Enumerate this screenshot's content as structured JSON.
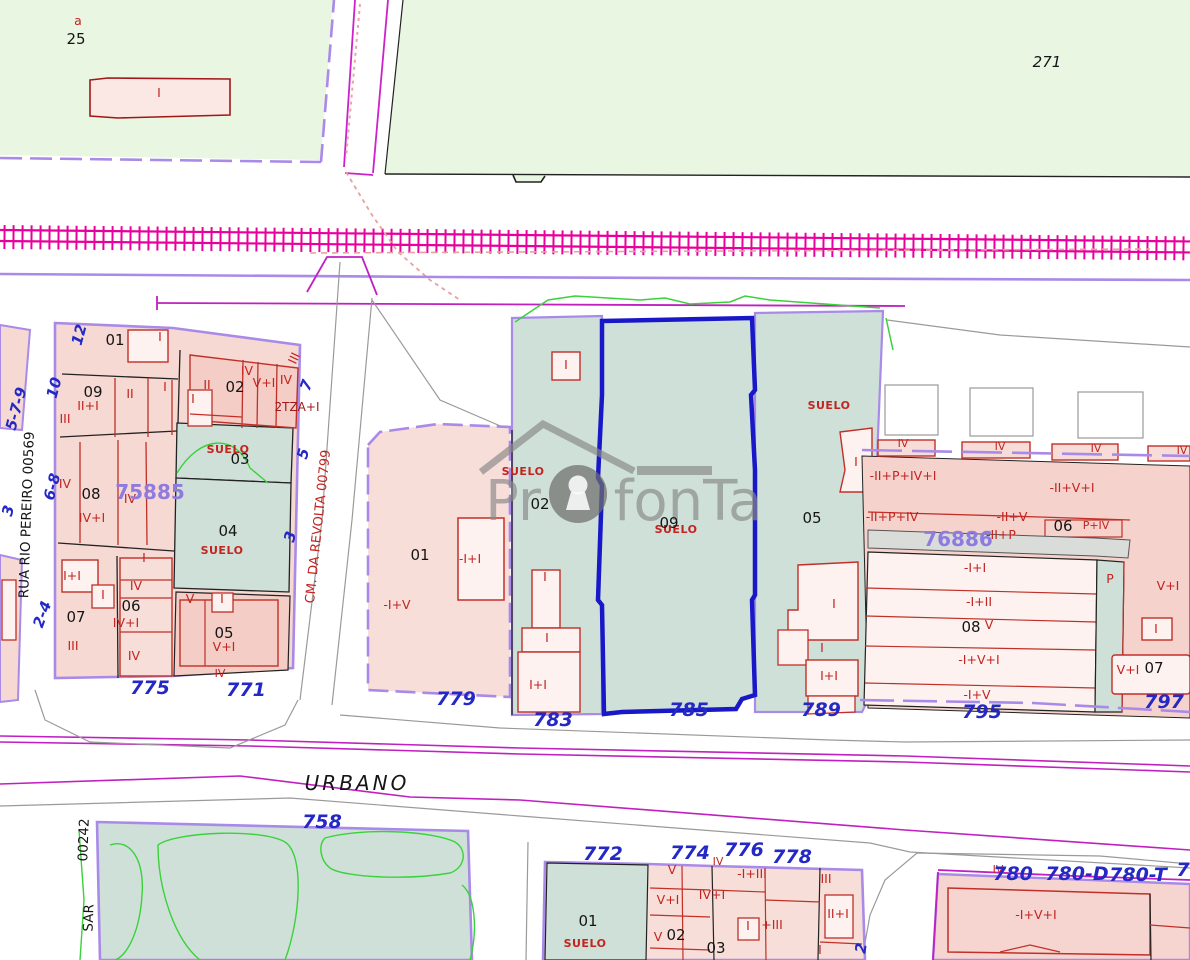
{
  "map": {
    "watermark": {
      "pr": "Pr",
      "rest": "fonTa"
    },
    "colors": {
      "green_bg": "#e9f6e2",
      "teal_suelo": "#cfe0d8",
      "pink_parcel": "#f6d9d3",
      "pink_light": "#fdf2ef",
      "pink_mid": "#f3cdc6",
      "boundary_purple": "#a98ae8",
      "selected_blue": "#1818c8",
      "railway_magenta": "#e8009c",
      "road_magenta": "#cc22cc",
      "building_red": "#c03028",
      "label_red": "#c22420",
      "street_number_blue": "#2428c4",
      "block_ref_purple": "#8f7ae0",
      "contour_green": "#3ad23a",
      "sidewalk_gray": "#9a9a9a"
    },
    "labels": [
      {
        "t": "a",
        "x": 78,
        "y": 25,
        "c": "red"
      },
      {
        "t": "25",
        "x": 76,
        "y": 44,
        "c": "blk"
      },
      {
        "t": "I",
        "x": 159,
        "y": 97,
        "c": "red"
      },
      {
        "t": "271",
        "x": 1047,
        "y": 67,
        "c": "ital"
      },
      {
        "t": "01",
        "x": 115,
        "y": 345,
        "c": "blk"
      },
      {
        "t": "I",
        "x": 160,
        "y": 341,
        "c": "red"
      },
      {
        "t": "02",
        "x": 235,
        "y": 392,
        "c": "blk"
      },
      {
        "t": "II",
        "x": 207,
        "y": 389,
        "c": "red"
      },
      {
        "t": "IV",
        "x": 247,
        "y": 375,
        "c": "red"
      },
      {
        "t": "V+I",
        "x": 264,
        "y": 387,
        "c": "red"
      },
      {
        "t": "IV",
        "x": 286,
        "y": 384,
        "c": "red"
      },
      {
        "t": "III",
        "x": 298,
        "y": 360,
        "c": "red",
        "rot": -65
      },
      {
        "t": "2TZA+I",
        "x": 297,
        "y": 411,
        "c": "dred"
      },
      {
        "t": "09",
        "x": 93,
        "y": 397,
        "c": "blk"
      },
      {
        "t": "II+I",
        "x": 88,
        "y": 410,
        "c": "red"
      },
      {
        "t": "II",
        "x": 130,
        "y": 398,
        "c": "red"
      },
      {
        "t": "I",
        "x": 165,
        "y": 391,
        "c": "red"
      },
      {
        "t": "I",
        "x": 193,
        "y": 403,
        "c": "red"
      },
      {
        "t": "III",
        "x": 65,
        "y": 423,
        "c": "red"
      },
      {
        "t": "SUELO",
        "x": 228,
        "y": 453,
        "c": "suelo"
      },
      {
        "t": "03",
        "x": 240,
        "y": 464,
        "c": "blk"
      },
      {
        "t": "IV",
        "x": 65,
        "y": 488,
        "c": "red"
      },
      {
        "t": "08",
        "x": 91,
        "y": 499,
        "c": "blk"
      },
      {
        "t": "IV",
        "x": 130,
        "y": 503,
        "c": "red"
      },
      {
        "t": "IV+I",
        "x": 92,
        "y": 522,
        "c": "red"
      },
      {
        "t": "75885",
        "x": 150,
        "y": 499,
        "c": "ref",
        "a": "start"
      },
      {
        "t": "04",
        "x": 228,
        "y": 536,
        "c": "blk"
      },
      {
        "t": "SUELO",
        "x": 222,
        "y": 554,
        "c": "suelo"
      },
      {
        "t": "I+I",
        "x": 72,
        "y": 580,
        "c": "red"
      },
      {
        "t": "I",
        "x": 103,
        "y": 599,
        "c": "red"
      },
      {
        "t": "07",
        "x": 76,
        "y": 622,
        "c": "blk"
      },
      {
        "t": "III",
        "x": 73,
        "y": 650,
        "c": "red"
      },
      {
        "t": "I",
        "x": 144,
        "y": 562,
        "c": "red"
      },
      {
        "t": "IV",
        "x": 136,
        "y": 590,
        "c": "red"
      },
      {
        "t": "06",
        "x": 131,
        "y": 611,
        "c": "blk"
      },
      {
        "t": "IV+I",
        "x": 126,
        "y": 627,
        "c": "red"
      },
      {
        "t": "IV",
        "x": 134,
        "y": 660,
        "c": "red"
      },
      {
        "t": "V",
        "x": 190,
        "y": 603,
        "c": "red"
      },
      {
        "t": "I",
        "x": 222,
        "y": 603,
        "c": "red"
      },
      {
        "t": "05",
        "x": 224,
        "y": 638,
        "c": "blk"
      },
      {
        "t": "V+I",
        "x": 224,
        "y": 651,
        "c": "red"
      },
      {
        "t": "IV",
        "x": 220,
        "y": 677,
        "c": "redS"
      },
      {
        "t": "775",
        "x": 150,
        "y": 694,
        "c": "blue"
      },
      {
        "t": "771",
        "x": 246,
        "y": 696,
        "c": "blue"
      },
      {
        "t": "5-7-9",
        "x": 21,
        "y": 410,
        "c": "blueS",
        "rot": -75
      },
      {
        "t": "3",
        "x": 13,
        "y": 512,
        "c": "blueS",
        "rot": -75
      },
      {
        "t": "12",
        "x": 84,
        "y": 336,
        "c": "blueS",
        "rot": -75
      },
      {
        "t": "10",
        "x": 59,
        "y": 389,
        "c": "blueS",
        "rot": -75
      },
      {
        "t": "6-8",
        "x": 57,
        "y": 488,
        "c": "blueS",
        "rot": -75
      },
      {
        "t": "2-4",
        "x": 47,
        "y": 616,
        "c": "blueS",
        "rot": -70
      },
      {
        "t": "RUA RIO PEREIRO 00569",
        "x": 31,
        "y": 515,
        "c": "stBlk",
        "rot": -88
      },
      {
        "t": "CM. DA REVOLTA 00799",
        "x": 322,
        "y": 527,
        "c": "stRed",
        "rot": -84
      },
      {
        "t": "7",
        "x": 311,
        "y": 387,
        "c": "blueS",
        "rot": -70
      },
      {
        "t": "5",
        "x": 308,
        "y": 455,
        "c": "blueS",
        "rot": -75
      },
      {
        "t": "3",
        "x": 295,
        "y": 538,
        "c": "blueS",
        "rot": -75
      },
      {
        "t": "01",
        "x": 420,
        "y": 560,
        "c": "blk"
      },
      {
        "t": "-I+V",
        "x": 397,
        "y": 609,
        "c": "red"
      },
      {
        "t": "-I+I",
        "x": 470,
        "y": 563,
        "c": "red"
      },
      {
        "t": "779",
        "x": 456,
        "y": 705,
        "c": "blue"
      },
      {
        "t": "SUELO",
        "x": 523,
        "y": 475,
        "c": "suelo"
      },
      {
        "t": "02",
        "x": 540,
        "y": 509,
        "c": "blk"
      },
      {
        "t": "I",
        "x": 566,
        "y": 369,
        "c": "red"
      },
      {
        "t": "I",
        "x": 545,
        "y": 581,
        "c": "red"
      },
      {
        "t": "I",
        "x": 547,
        "y": 642,
        "c": "red"
      },
      {
        "t": "I+I",
        "x": 538,
        "y": 689,
        "c": "red"
      },
      {
        "t": "783",
        "x": 553,
        "y": 726,
        "c": "blue"
      },
      {
        "t": "SUELO",
        "x": 676,
        "y": 533,
        "c": "suelo"
      },
      {
        "t": "09",
        "x": 669,
        "y": 528,
        "c": "blk"
      },
      {
        "t": "785",
        "x": 689,
        "y": 716,
        "c": "blue"
      },
      {
        "t": "SUELO",
        "x": 829,
        "y": 409,
        "c": "suelo"
      },
      {
        "t": "05",
        "x": 812,
        "y": 523,
        "c": "blk"
      },
      {
        "t": "I",
        "x": 856,
        "y": 466,
        "c": "red"
      },
      {
        "t": "-II+P+IV+I",
        "x": 903,
        "y": 480,
        "c": "red"
      },
      {
        "t": "-II+P+IV",
        "x": 892,
        "y": 521,
        "c": "red"
      },
      {
        "t": "I",
        "x": 834,
        "y": 608,
        "c": "red"
      },
      {
        "t": "I",
        "x": 822,
        "y": 652,
        "c": "red"
      },
      {
        "t": "I+I",
        "x": 829,
        "y": 680,
        "c": "red"
      },
      {
        "t": "789",
        "x": 821,
        "y": 716,
        "c": "blue"
      },
      {
        "t": "IV",
        "x": 903,
        "y": 447,
        "c": "redS"
      },
      {
        "t": "IV",
        "x": 1000,
        "y": 450,
        "c": "redS"
      },
      {
        "t": "IV",
        "x": 1096,
        "y": 452,
        "c": "redS"
      },
      {
        "t": "IV",
        "x": 1182,
        "y": 454,
        "c": "redS"
      },
      {
        "t": "-II+V+I",
        "x": 1072,
        "y": 492,
        "c": "red"
      },
      {
        "t": "-II+V",
        "x": 1012,
        "y": 521,
        "c": "red"
      },
      {
        "t": "-II+P",
        "x": 1001,
        "y": 539,
        "c": "red"
      },
      {
        "t": "P+IV",
        "x": 1096,
        "y": 529,
        "c": "redS"
      },
      {
        "t": "06",
        "x": 1063,
        "y": 531,
        "c": "blk"
      },
      {
        "t": "76886",
        "x": 958,
        "y": 546,
        "c": "ref",
        "a": "start"
      },
      {
        "t": "-I+I",
        "x": 975,
        "y": 572,
        "c": "red"
      },
      {
        "t": "-I+II",
        "x": 979,
        "y": 606,
        "c": "red"
      },
      {
        "t": "08",
        "x": 971,
        "y": 632,
        "c": "blk"
      },
      {
        "t": "V",
        "x": 989,
        "y": 629,
        "c": "red"
      },
      {
        "t": "-I+V+I",
        "x": 979,
        "y": 664,
        "c": "red"
      },
      {
        "t": "-I+V",
        "x": 977,
        "y": 699,
        "c": "red"
      },
      {
        "t": "795",
        "x": 982,
        "y": 718,
        "c": "blue"
      },
      {
        "t": "P",
        "x": 1110,
        "y": 583,
        "c": "red"
      },
      {
        "t": "V+I",
        "x": 1168,
        "y": 590,
        "c": "red"
      },
      {
        "t": "I",
        "x": 1156,
        "y": 633,
        "c": "red"
      },
      {
        "t": "V+I",
        "x": 1128,
        "y": 674,
        "c": "red"
      },
      {
        "t": "07",
        "x": 1154,
        "y": 673,
        "c": "blk"
      },
      {
        "t": "797",
        "x": 1164,
        "y": 708,
        "c": "blue"
      },
      {
        "t": "URBANO",
        "x": 357,
        "y": 790,
        "c": "urb"
      },
      {
        "t": "758",
        "x": 322,
        "y": 828,
        "c": "blue"
      },
      {
        "t": "00242",
        "x": 88,
        "y": 840,
        "c": "stBlk",
        "rot": -88
      },
      {
        "t": "SAR",
        "x": 93,
        "y": 918,
        "c": "stBlk",
        "rot": -88
      },
      {
        "t": "772",
        "x": 603,
        "y": 860,
        "c": "blue"
      },
      {
        "t": "774",
        "x": 690,
        "y": 859,
        "c": "blue"
      },
      {
        "t": "776",
        "x": 744,
        "y": 856,
        "c": "blue"
      },
      {
        "t": "778",
        "x": 792,
        "y": 863,
        "c": "blue"
      },
      {
        "t": "01",
        "x": 588,
        "y": 926,
        "c": "blk"
      },
      {
        "t": "SUELO",
        "x": 585,
        "y": 947,
        "c": "suelo"
      },
      {
        "t": "V",
        "x": 672,
        "y": 874,
        "c": "red"
      },
      {
        "t": "V+I",
        "x": 668,
        "y": 904,
        "c": "red"
      },
      {
        "t": "V",
        "x": 658,
        "y": 941,
        "c": "red"
      },
      {
        "t": "02",
        "x": 676,
        "y": 940,
        "c": "blk"
      },
      {
        "t": "IV",
        "x": 718,
        "y": 865,
        "c": "redS"
      },
      {
        "t": "IV+I",
        "x": 712,
        "y": 899,
        "c": "red"
      },
      {
        "t": "03",
        "x": 716,
        "y": 953,
        "c": "blk"
      },
      {
        "t": "-I+III",
        "x": 752,
        "y": 878,
        "c": "red"
      },
      {
        "t": "I",
        "x": 748,
        "y": 930,
        "c": "red"
      },
      {
        "t": "+III",
        "x": 772,
        "y": 929,
        "c": "red"
      },
      {
        "t": "III",
        "x": 826,
        "y": 883,
        "c": "red"
      },
      {
        "t": "II+I",
        "x": 838,
        "y": 918,
        "c": "red"
      },
      {
        "t": "I",
        "x": 820,
        "y": 954,
        "c": "red"
      },
      {
        "t": "2",
        "x": 866,
        "y": 949,
        "c": "blueS",
        "rot": -80
      },
      {
        "t": "IV",
        "x": 998,
        "y": 873,
        "c": "redS"
      },
      {
        "t": "780",
        "x": 1013,
        "y": 880,
        "c": "blue"
      },
      {
        "t": "780-D",
        "x": 1077,
        "y": 880,
        "c": "blue"
      },
      {
        "t": "780-T",
        "x": 1138,
        "y": 881,
        "c": "blue"
      },
      {
        "t": "7",
        "x": 1183,
        "y": 876,
        "c": "blue"
      },
      {
        "t": "-I+V+I",
        "x": 1036,
        "y": 919,
        "c": "red"
      }
    ]
  }
}
